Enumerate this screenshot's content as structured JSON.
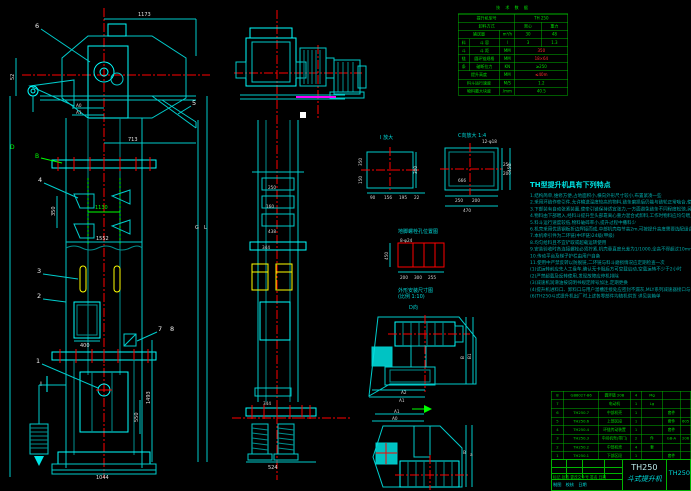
{
  "colors": {
    "line": "#00cccc",
    "bright": "#00ffff",
    "center": "#ff0000",
    "table": "#00b400",
    "dim_text": "#e0e0e0",
    "note": "#00a9a9",
    "bucket": "#ffff00",
    "motor_underline": "#ff00ff"
  },
  "tech": {
    "title": "技 术 数 据",
    "rows": [
      [
        {
          "t": "提升机型号",
          "w": 52
        },
        {
          "t": "TH 250",
          "w": 48
        }
      ],
      [
        {
          "t": "卸料方式",
          "w": 52
        },
        {
          "t": "离心",
          "w": 24
        },
        {
          "t": "重力",
          "w": 24
        }
      ],
      [
        {
          "t": "输送量",
          "w": 38
        },
        {
          "t": "m³/h",
          "w": 14
        },
        {
          "t": "30",
          "w": 24
        },
        {
          "t": "48",
          "w": 24
        }
      ],
      [
        {
          "t": "料",
          "w": 10
        },
        {
          "t": "斗 容",
          "w": 28
        },
        {
          "t": "l",
          "w": 14
        },
        {
          "t": "3",
          "w": 24
        },
        {
          "t": "1.3",
          "w": 24
        }
      ],
      [
        {
          "t": "斗",
          "w": 10
        },
        {
          "t": "斗 距",
          "w": 28
        },
        {
          "t": "MM",
          "w": 14
        },
        {
          "t": "350",
          "w": 48,
          "c": "red"
        }
      ],
      [
        {
          "t": "链",
          "w": 10
        },
        {
          "t": "圆环链规格",
          "w": 28
        },
        {
          "t": "MM",
          "w": 14
        },
        {
          "t": "18×64",
          "w": 48,
          "c": "red"
        }
      ],
      [
        {
          "t": "条",
          "w": 10
        },
        {
          "t": "破断拉力",
          "w": 28
        },
        {
          "t": "KN",
          "w": 14
        },
        {
          "t": "≥250",
          "w": 48
        }
      ],
      [
        {
          "t": "提升高度",
          "w": 38
        },
        {
          "t": "MM",
          "w": 14
        },
        {
          "t": "≤40m",
          "w": 48,
          "c": "red"
        }
      ],
      [
        {
          "t": "料斗运行速度",
          "w": 38
        },
        {
          "t": "M/S",
          "w": 14
        },
        {
          "t": "1.2",
          "w": 48
        }
      ],
      [
        {
          "t": "物料最大块度",
          "w": 38
        },
        {
          "t": "/mm",
          "w": 14
        },
        {
          "t": "40.5",
          "w": 48
        }
      ]
    ]
  },
  "features": {
    "title": "TH型提升机具有下列特点",
    "lines": [
      "1.结构简单,维修方便,占地面积小,横向外形尺寸较小,布置紧凑一些",
      "2.采用环链作牵引件,允许输送温度较高的物料,链条磨损后仍能与链轮正常啮合,使用寿命较一般胶带式长,适用于水泥、碎石、砂等磨琢性较大的物料",
      "3.下部装有自动张紧装置,使牵引链保持适宜张力,一方面避免链条不同程度松弛,另一方面防止张力过大而加剧链条与链轮的磨损",
      "4.物料由下部喂入,经料斗提升至头部靠离心重力混合式卸料,工作时物料应均匀喂入,不宜直接铲取,严禁大块物料及杂物混入,以免造成堵塞事故,影响正常运转",
      "5.料斗运行速度较低,物料破碎率小,提升过程中撒料少",
      "",
      "6.机壳采用优质钢板折边焊接而成,中部机壳每节高2m,可按提升高度需要选配组合",
      "7.本机牵引件为二环链(中环链)24级(甲级)",
      "8.均匀给料且不宜铲取或超载运转使用",
      "9.安装验收时各连接螺栓必须拧紧,机壳垂直度允差为1/1000,全高不得超过10mm",
      "10.传动平台及梯子护栏由用户自备",
      "11.使用中严禁反转以防脱链,二环链与料斗磨损情况应定期检查一次",
      "",
      "(1)试运转前应先人工盘车,确认无卡阻后方可空载启动,空载运转不少于2小时",
      "(2)严禁超载及反转使用,发现故障应停机排除",
      "(3)减速机润滑油按说明书规定牌号加注,定期更换",
      "(4)提升机进料口、卸料口与用户溜槽连接处应密封不漏灰,MLY系列减速器接口与电机安装尺寸见本图样",
      "",
      "(6)TH250斗式提升机出厂时上述各零部件均随机供货 详见装箱单"
    ]
  },
  "parts": {
    "rows": [
      [
        "8",
        "GB8027-86",
        "圆环链 20B",
        "4",
        "Mg",
        "",
        ""
      ],
      [
        "7",
        "",
        "电动机",
        "1",
        "Lg",
        "",
        ""
      ],
      [
        "6",
        "TH250.7",
        "中部机壳",
        "1",
        "",
        "套件",
        ""
      ],
      [
        "5",
        "TH250.6",
        "上部区段",
        "1",
        "",
        "套件",
        "605"
      ],
      [
        "4",
        "TH250.4",
        "环链传动装置",
        "1",
        "",
        "套件",
        ""
      ],
      [
        "3",
        "TH250.3",
        "中间机壳(带门)",
        "2",
        "件",
        "GB-A",
        "206"
      ],
      [
        "2",
        "TH250.2",
        "中部机壳",
        "4",
        "套",
        "",
        ""
      ],
      [
        "1",
        "TH250.1",
        "下部区段",
        "1",
        "",
        "套件",
        ""
      ],
      [
        "件号",
        "代 号",
        "名 称",
        "数量",
        "材 料",
        "单重",
        "备注"
      ]
    ]
  },
  "title_block": {
    "model": "TH250",
    "product": "斗式提升机",
    "doc_no": "TH250",
    "revision_row": "标记 处数 更改文件号 签名 日期",
    "sign_row": "制图　校核　日期"
  },
  "labels": {
    "n1": "1",
    "n2": "2",
    "n3": "3",
    "n4": "4",
    "n5": "5",
    "n6": "6",
    "n7": "7",
    "n8": "8",
    "lB": "B",
    "lD": "D",
    "sectI": "I",
    "viewI": "I 放大",
    "viewC": "C向放大 1:4",
    "viewD": "D向",
    "capBolt": "地脚螺栓孔位置图",
    "capOutline1": "外形安装尺寸图",
    "capOutline2": "(比例 1:10)"
  },
  "dims": {
    "d1173": "1173",
    "d52": "52",
    "a0": "A0",
    "a1": "A1",
    "d713": "713",
    "d350": "350",
    "d1130": "1130",
    "d1552": "1552",
    "d400": "400",
    "d1493": "1493",
    "d550": "550",
    "d1044": "1044",
    "dG": "G",
    "dL": "L",
    "s250": "250",
    "s160": "160",
    "s438": "438",
    "s344a": "344",
    "s344b": "344",
    "s524": "524",
    "i300": "300",
    "i350": "350",
    "i150": "150",
    "i90": "90",
    "i156": "156",
    "i195": "195",
    "i22": "22",
    "c666": "666",
    "c12f": "12-φ18",
    "c250a": "250",
    "c200a": "200",
    "c470": "470",
    "c250b": "250",
    "c200b": "200",
    "c450": "450",
    "g8f": "8-φ24",
    "g450": "450",
    "g200": "200",
    "g300": "300",
    "g255": "255",
    "pA2": "A2",
    "pA1": "A1",
    "pB": "B",
    "pB1": "B1",
    "qA1": "A1",
    "qA0": "A0",
    "qB": "B",
    "qa": "a"
  }
}
